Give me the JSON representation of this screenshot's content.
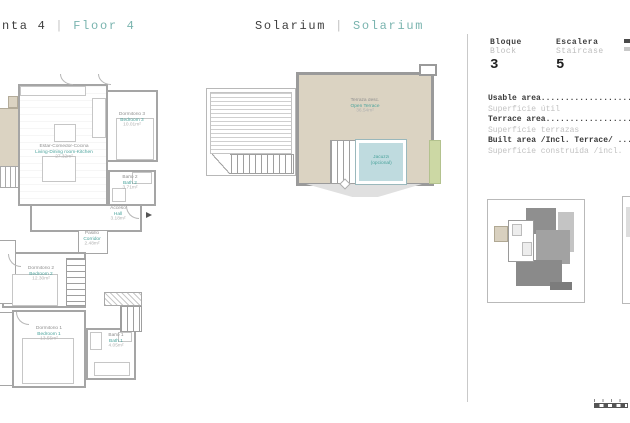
{
  "colors": {
    "accent": "#4aa39c",
    "accent_light": "#7ab4af",
    "terrace_beige": "#dbd3c2",
    "jacuzzi_blue": "#bfdbdf",
    "planter_green": "#ccd8a4"
  },
  "header": {
    "floor_title": {
      "left": "nta 4",
      "sep": "|",
      "right": "Floor 4"
    },
    "solarium_title": {
      "left": "Solarium",
      "sep": "|",
      "right": "Solarium"
    }
  },
  "panel": {
    "bloque": {
      "label_es": "Bloque",
      "label_en": "Block",
      "value": "3"
    },
    "escalera": {
      "label_es": "Escalera",
      "label_en": "Staircase",
      "value": "5"
    },
    "areas": [
      {
        "en": "Usable area...................",
        "es": "Superficie útil"
      },
      {
        "en": "Terrace area..................",
        "es": "Superficie terrazas"
      },
      {
        "en": "Built area /Incl. Terrace/ ...",
        "es": "Superficie construida /incl."
      }
    ]
  },
  "plan": {
    "rooms": [
      {
        "es": "Estar-Comedor-Cocina",
        "en": "Living-Dining room-Kitchen",
        "area": "27.32m²"
      },
      {
        "es": "Dormitorio 3",
        "en": "Bedroom 3",
        "area": "10.01m²"
      },
      {
        "es": "Baño 2",
        "en": "Bath 2",
        "area": "3.71m²"
      },
      {
        "es": "Acceso",
        "en": "Hall",
        "area": "3.18m²"
      },
      {
        "es": "Pasillo",
        "en": "Corridor",
        "area": "2.48m²"
      },
      {
        "es": "Dormitorio 2",
        "en": "Bedroom 2",
        "area": "12.30m²"
      },
      {
        "es": "Dormitorio 1",
        "en": "Bedroom 1",
        "area": "13.55m²"
      },
      {
        "es": "Baño 1",
        "en": "Bath 1",
        "area": "4.05m²"
      }
    ]
  },
  "solarium": {
    "terrace": {
      "es": "Terraza desc.",
      "en": "Open Terrace",
      "area": "36.54m²"
    },
    "jacuzzi": {
      "line1": "Jacuzzi",
      "line2": "(opcional)"
    }
  }
}
